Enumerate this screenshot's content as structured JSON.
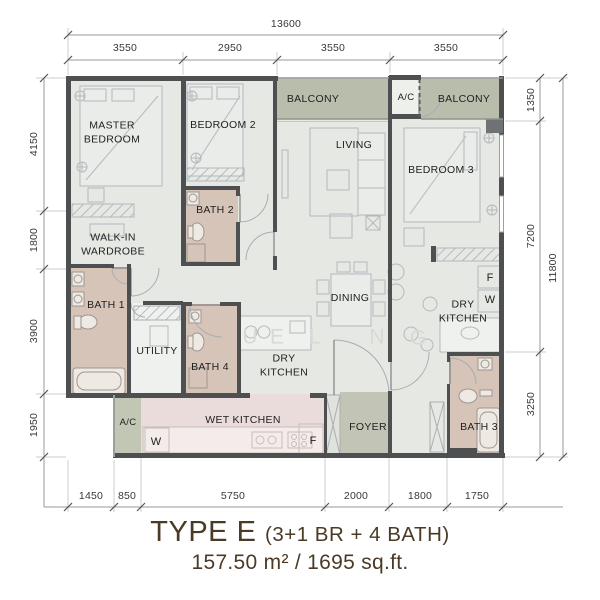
{
  "title": {
    "type_label": "TYPE E",
    "config_label": "(3+1 BR + 4 BATH)",
    "area_label": "157.50 m² / 1695 sq.ft."
  },
  "rooms": {
    "master_bedroom": "MASTER BEDROOM",
    "bedroom_2": "BEDROOM 2",
    "bedroom_3": "BEDROOM 3",
    "living": "LIVING",
    "dining": "DINING",
    "balcony_left": "BALCONY",
    "balcony_right": "BALCONY",
    "ac_top": "A/C",
    "ac_bottom": "A/C",
    "walk_in_wardrobe": "WALK-IN WARDROBE",
    "bath_1": "BATH 1",
    "bath_2": "BATH 2",
    "bath_3": "BATH 3",
    "bath_4": "BATH 4",
    "utility": "UTILITY",
    "dry_kitchen_mid": "DRY KITCHEN",
    "dry_kitchen_right": "DRY KITCHEN",
    "wet_kitchen": "WET KITCHEN",
    "foyer": "FOYER"
  },
  "appliances": {
    "fridge": "F",
    "washer": "W"
  },
  "dimensions": {
    "top_total": "13600",
    "top": [
      "3550",
      "2950",
      "3550",
      "3550"
    ],
    "left": [
      "4150",
      "1800",
      "3900",
      "1950"
    ],
    "right": [
      "1350",
      "7200",
      "3250"
    ],
    "right_total": "11800",
    "bottom": [
      "1450",
      "850",
      "5750",
      "2000",
      "1800",
      "1750"
    ]
  },
  "watermark": [
    "U",
    "E",
    "L",
    "N",
    "G"
  ],
  "colors": {
    "wall": "#4d4f51",
    "floor": "#e6e8e4",
    "balcony": "#b9bdac",
    "foyer": "#c2c5b5",
    "bath": "#d7c4b9",
    "wet_kitchen": "#eadcda",
    "utility_floor": "#eff1ee",
    "title_text": "#4a3a26",
    "label_text": "#1f1f1f",
    "dim_text": "#383838"
  }
}
